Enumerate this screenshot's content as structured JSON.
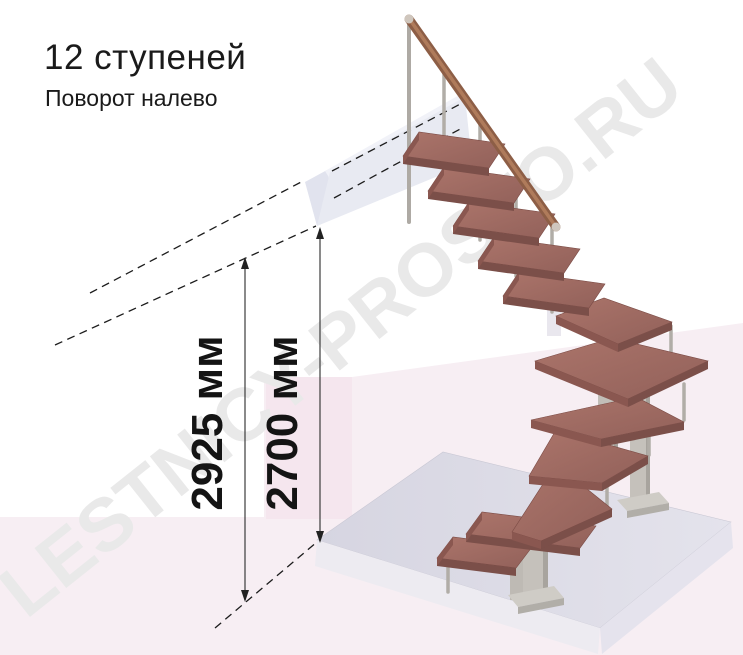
{
  "page": {
    "title": "12 ступеней",
    "subtitle": "Поворот налево"
  },
  "dimensions": {
    "floor_to_floor": "2925 мм",
    "floor_to_ceiling": "2700 мм"
  },
  "watermark": {
    "text": "LESTNICY-PROSTO.RU"
  },
  "colors": {
    "tread_wood": "#9b6a62",
    "tread_edge": "#7b4f49",
    "handrail_wood": "#8d5e46",
    "steel": "#c5c1bb",
    "floor_slab": "#dbdae5",
    "landing": "#e8eaf2",
    "background_pink": "#f7eef3",
    "dimension_text": "#141414",
    "watermark_gray": "#e9e9e9"
  }
}
